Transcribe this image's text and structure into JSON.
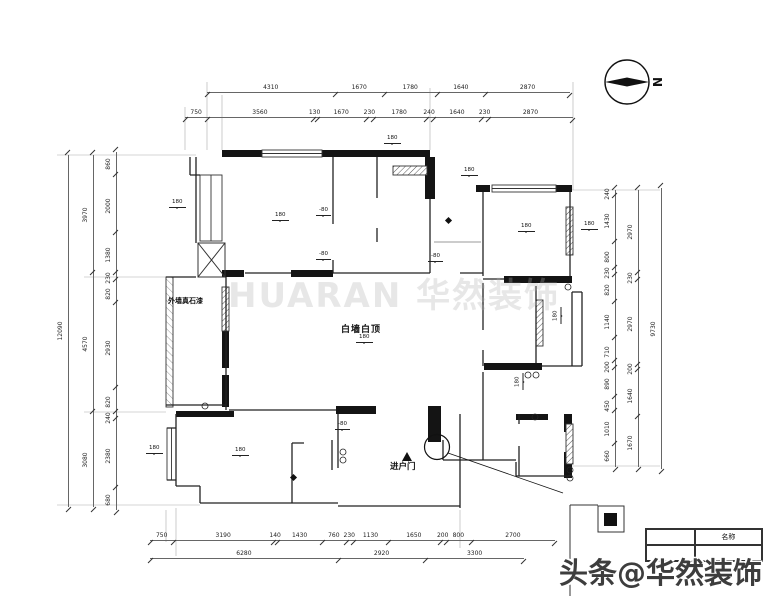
{
  "north_label": "N",
  "watermarks": {
    "center": "HUARAN 华然装饰",
    "bottom": "头条@华然装饰"
  },
  "plan_labels": {
    "center_room": "白墙白顶",
    "center_room_level": "180",
    "exterior_wall": "外墙真石漆",
    "entry_door": "进户门"
  },
  "title_block": {
    "header": "名称"
  },
  "elevation_marks": [
    "180",
    "-80",
    "-80",
    "180",
    "180",
    "180",
    "180",
    "180",
    "180",
    "-80",
    "180",
    "180",
    "180",
    "-80"
  ],
  "dimensions": {
    "top_row1": [
      "4310",
      "1670",
      "1780",
      "1640",
      "2870"
    ],
    "top_row2": [
      "750",
      "3560",
      "130",
      "1670",
      "230",
      "1780",
      "240",
      "1640",
      "230",
      "2870"
    ],
    "left_outer": [
      "12090"
    ],
    "left_mid": [
      "3970",
      "4570",
      "3080"
    ],
    "left_inner": [
      "860",
      "2000",
      "1380",
      "230",
      "820",
      "2930",
      "820",
      "240",
      "2380",
      "680"
    ],
    "right_inner": [
      "240",
      "1430",
      "800",
      "230",
      "820",
      "1140",
      "710",
      "200",
      "890",
      "450",
      "1010",
      "660"
    ],
    "right_mid": [
      "2970",
      "230",
      "2970",
      "200",
      "1640",
      "1670"
    ],
    "right_outer": [
      "9730"
    ],
    "bottom_row1": [
      "750",
      "3190",
      "140",
      "1430",
      "760",
      "230",
      "1130",
      "1650",
      "200",
      "800",
      "2700"
    ],
    "bottom_row2": [
      "6280",
      "2920",
      "3300"
    ]
  }
}
